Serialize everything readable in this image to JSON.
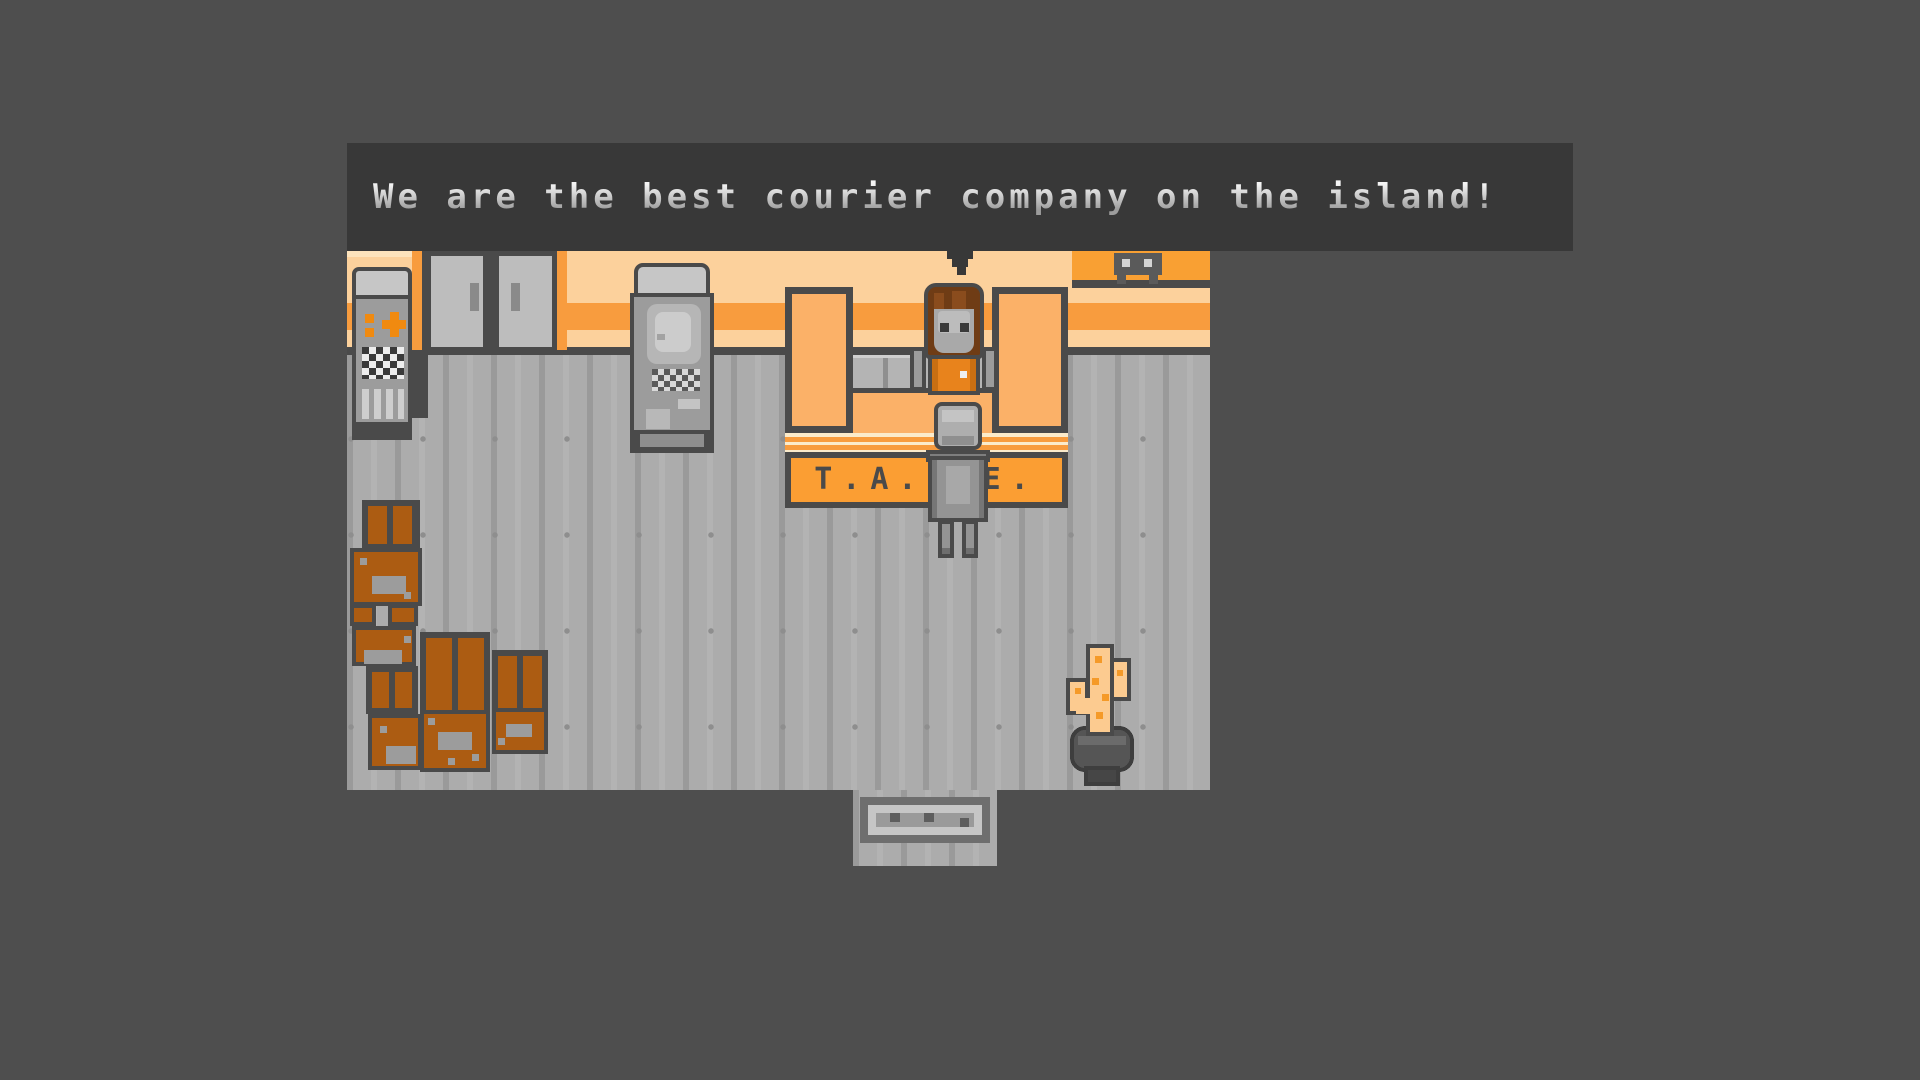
{
  "dialog": {
    "text": "We are the best courier company on the island!"
  },
  "counter": {
    "sign_text": "T.A.P.E."
  },
  "colors": {
    "page_bg": "#4E4E4E",
    "dialog_bg": "#383838",
    "dialog_text": "#C8C8C8",
    "wall_peach": "#FCD19C",
    "wall_stripe_orange": "#F89C3E",
    "counter_orange": "#FBB168",
    "sign_orange": "#FB9E33",
    "counter_edge_cream": "#FBEBCB",
    "outline_dark": "#4A4A4A",
    "floor_gray": "#ACACAC",
    "machine_gray": "#9C9C9C",
    "machine_cap_gray": "#C6C6C6",
    "door_gray": "#BDBDBD",
    "crate_brown": "#AC5C12",
    "flame_peach": "#FCCB90",
    "flame_orange": "#F59A28",
    "jacket_orange": "#E8831C",
    "hair_brown": "#6F3C15",
    "symbol_orange": "#F08A10"
  }
}
